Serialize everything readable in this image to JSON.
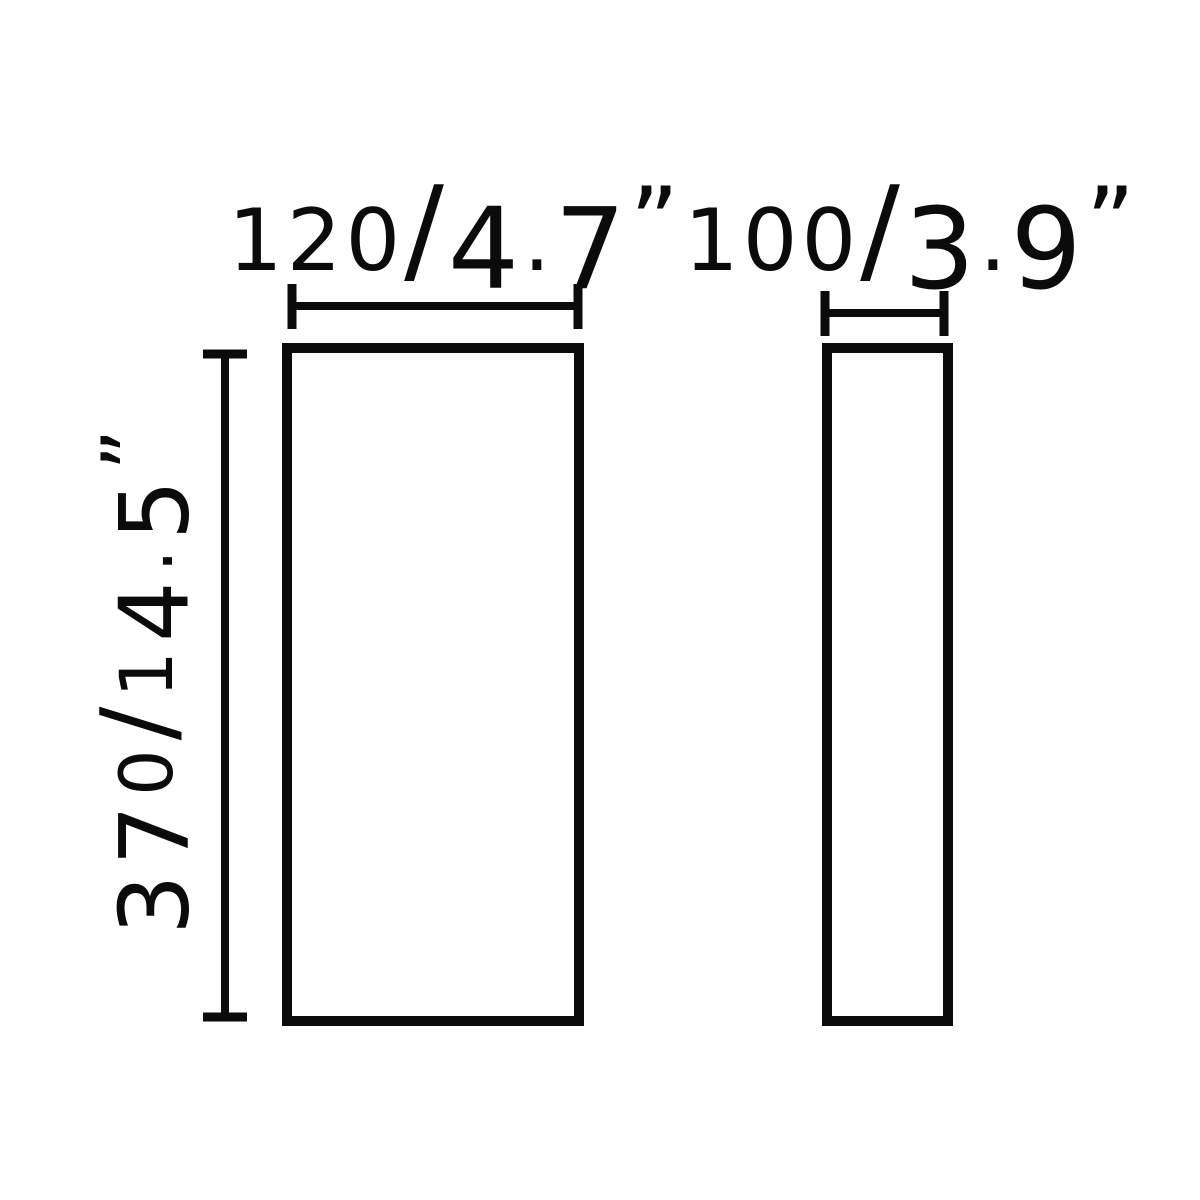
{
  "colors": {
    "background": "#ffffff",
    "ink": "#0b0b0b"
  },
  "diagram": {
    "description": "Technical dimension drawing with front and side view outlines",
    "views": {
      "front": {
        "name": "front-view"
      },
      "side": {
        "name": "side-view"
      }
    },
    "dimensions": {
      "front_width": {
        "label": "120/4.7”",
        "millimeters": 120,
        "inches": 4.7
      },
      "side_width": {
        "label": "100/3.9”",
        "millimeters": 100,
        "inches": 3.9
      },
      "height": {
        "label": "370/14.5”",
        "millimeters": 370,
        "inches": 14.5
      }
    }
  }
}
